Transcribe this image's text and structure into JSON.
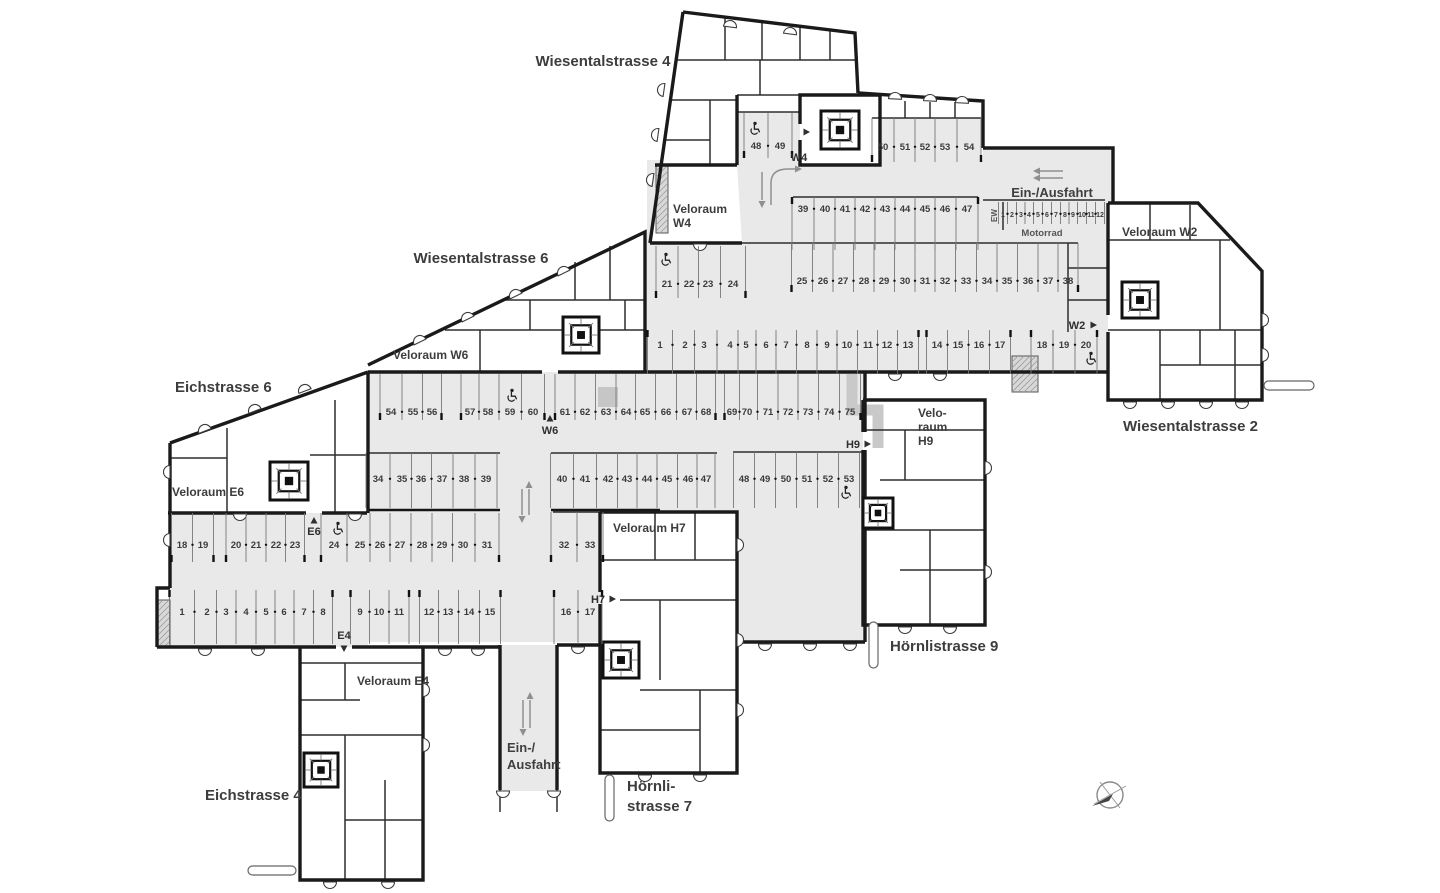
{
  "streets": [
    {
      "id": "wiesentalstrasse-4",
      "text": "Wiesentalstrasse 4",
      "x": 603,
      "y": 66,
      "anchor": "middle"
    },
    {
      "id": "wiesentalstrasse-6",
      "text": "Wiesentalstrasse 6",
      "x": 481,
      "y": 263,
      "anchor": "middle"
    },
    {
      "id": "eichstrasse-6",
      "text": "Eichstrasse 6",
      "x": 175,
      "y": 392,
      "anchor": "start"
    },
    {
      "id": "eichstrasse-4",
      "text": "Eichstrasse 4",
      "x": 205,
      "y": 800,
      "anchor": "start"
    },
    {
      "id": "hoernlistrasse-7",
      "lines": [
        "Hörnli-",
        "strasse 7"
      ],
      "x": 627,
      "y": 791,
      "anchor": "start"
    },
    {
      "id": "hoernlistrasse-9",
      "text": "Hörnlistrasse 9",
      "x": 890,
      "y": 651,
      "anchor": "start"
    },
    {
      "id": "wiesentalstrasse-2",
      "text": "Wiesentalstrasse 2",
      "x": 1123,
      "y": 431,
      "anchor": "start"
    }
  ],
  "room_labels": [
    {
      "id": "veloraum-w4",
      "lines": [
        "Veloraum",
        "W4"
      ],
      "x": 673,
      "y": 213
    },
    {
      "id": "veloraum-w6",
      "lines": [
        "Veloraum W6"
      ],
      "x": 393,
      "y": 359
    },
    {
      "id": "veloraum-e6",
      "lines": [
        "Veloraum E6"
      ],
      "x": 172,
      "y": 496
    },
    {
      "id": "veloraum-e4",
      "lines": [
        "Veloraum E4"
      ],
      "x": 357,
      "y": 685
    },
    {
      "id": "veloraum-h7",
      "lines": [
        "Veloraum H7"
      ],
      "x": 613,
      "y": 532
    },
    {
      "id": "veloraum-h9",
      "lines": [
        "Velo-",
        "raum",
        "H9"
      ],
      "x": 918,
      "y": 417
    },
    {
      "id": "veloraum-w2",
      "lines": [
        "Veloraum W2"
      ],
      "x": 1122,
      "y": 236
    }
  ],
  "entrance_markers": [
    {
      "id": "w4",
      "text": "W4",
      "x": 799,
      "y": 161,
      "tri": "right",
      "tx": 806,
      "ty": 132
    },
    {
      "id": "w6",
      "text": "W6",
      "x": 550,
      "y": 434,
      "tri": "up",
      "tx": 550,
      "ty": 419
    },
    {
      "id": "e6",
      "text": "E6",
      "x": 314,
      "y": 535,
      "tri": "up",
      "tx": 314,
      "ty": 521
    },
    {
      "id": "e4",
      "text": "E4",
      "x": 344,
      "y": 639,
      "tri": "down",
      "tx": 344,
      "ty": 648
    },
    {
      "id": "w2",
      "text": "W2",
      "x": 1077,
      "y": 329,
      "tri": "right",
      "tx": 1093,
      "ty": 325
    },
    {
      "id": "h7",
      "text": "H7",
      "x": 598,
      "y": 603,
      "tri": "right",
      "tx": 612,
      "ty": 599
    },
    {
      "id": "h9",
      "text": "H9",
      "x": 853,
      "y": 448,
      "tri": "right",
      "tx": 867,
      "ty": 444
    }
  ],
  "driveway_labels": [
    {
      "id": "ein-ausfahrt-top",
      "lines": [
        "Ein-/Ausfahrt"
      ],
      "x": 1052,
      "y": 197,
      "anchor": "middle"
    },
    {
      "id": "ein-ausfahrt-bottom",
      "lines": [
        "Ein-/",
        "Ausfahrt"
      ],
      "x": 507,
      "y": 752,
      "anchor": "start"
    }
  ],
  "motorrad": {
    "label": "Motorrad",
    "lx": 1042,
    "ly": 236,
    "ew": "EW",
    "ewx": 997,
    "ewy": 222,
    "row": {
      "id": "motorrad-row",
      "y1": 202,
      "y2": 224,
      "ty": 217,
      "fs": 7,
      "tick": "none",
      "spots": [
        {
          "n": "1",
          "x": 1003
        },
        {
          "n": "2",
          "x": 1012
        },
        {
          "n": "3",
          "x": 1021
        },
        {
          "n": "4",
          "x": 1029
        },
        {
          "n": "5",
          "x": 1038
        },
        {
          "n": "6",
          "x": 1047
        },
        {
          "n": "7",
          "x": 1056
        },
        {
          "n": "8",
          "x": 1065
        },
        {
          "n": "9",
          "x": 1073
        },
        {
          "n": "10",
          "x": 1082
        },
        {
          "n": "11",
          "x": 1091
        },
        {
          "n": "12",
          "x": 1100
        }
      ]
    }
  },
  "parking_rows": [
    {
      "id": "w-48-49",
      "y1": 113,
      "y2": 158,
      "ty": 149,
      "tick": "bottom",
      "spots": [
        {
          "n": "48",
          "x": 756
        },
        {
          "n": "49",
          "x": 780
        }
      ]
    },
    {
      "id": "w-50-54",
      "y1": 118,
      "y2": 162,
      "ty": 150,
      "tick": "bottom",
      "spots": [
        {
          "n": "50",
          "x": 883
        },
        {
          "n": "51",
          "x": 905
        },
        {
          "n": "52",
          "x": 925
        },
        {
          "n": "53",
          "x": 945
        },
        {
          "n": "54",
          "x": 969
        }
      ]
    },
    {
      "id": "w-39-47",
      "y1": 197,
      "y2": 250,
      "ty": 212,
      "tick": "top",
      "spots": [
        {
          "n": "39",
          "x": 803
        },
        {
          "n": "40",
          "x": 825
        },
        {
          "n": "41",
          "x": 845
        },
        {
          "n": "42",
          "x": 865
        },
        {
          "n": "43",
          "x": 885
        },
        {
          "n": "44",
          "x": 905
        },
        {
          "n": "45",
          "x": 925
        },
        {
          "n": "46",
          "x": 945
        },
        {
          "n": "47",
          "x": 967
        }
      ]
    },
    {
      "id": "w-21-24",
      "y1": 246,
      "y2": 298,
      "ty": 287,
      "tick": "bottom",
      "spots": [
        {
          "n": "21",
          "x": 667
        },
        {
          "n": "22",
          "x": 689
        },
        {
          "n": "23",
          "x": 708
        },
        {
          "n": "24",
          "x": 733
        }
      ]
    },
    {
      "id": "w-25-38",
      "y1": 243,
      "y2": 292,
      "ty": 284,
      "tick": "bottom",
      "spots": [
        {
          "n": "25",
          "x": 802
        },
        {
          "n": "26",
          "x": 823
        },
        {
          "n": "27",
          "x": 843
        },
        {
          "n": "28",
          "x": 864
        },
        {
          "n": "29",
          "x": 884
        },
        {
          "n": "30",
          "x": 905
        },
        {
          "n": "31",
          "x": 925
        },
        {
          "n": "32",
          "x": 945
        },
        {
          "n": "33",
          "x": 966
        },
        {
          "n": "34",
          "x": 987
        },
        {
          "n": "35",
          "x": 1007
        },
        {
          "n": "36",
          "x": 1028
        },
        {
          "n": "37",
          "x": 1048
        },
        {
          "n": "38",
          "x": 1068
        }
      ]
    },
    {
      "id": "w-1-13",
      "y1": 330,
      "y2": 374,
      "ty": 348,
      "tick": "top",
      "spots": [
        {
          "n": "1",
          "x": 660
        },
        {
          "n": "2",
          "x": 685
        },
        {
          "n": "3",
          "x": 704
        },
        {
          "n": "4",
          "x": 730
        },
        {
          "n": "5",
          "x": 746
        },
        {
          "n": "6",
          "x": 766
        },
        {
          "n": "7",
          "x": 786
        },
        {
          "n": "8",
          "x": 807
        },
        {
          "n": "9",
          "x": 827
        },
        {
          "n": "10",
          "x": 847
        },
        {
          "n": "11",
          "x": 868
        },
        {
          "n": "12",
          "x": 887
        },
        {
          "n": "13",
          "x": 908
        }
      ]
    },
    {
      "id": "w-14-17",
      "y1": 330,
      "y2": 374,
      "ty": 348,
      "tick": "top",
      "spots": [
        {
          "n": "14",
          "x": 937
        },
        {
          "n": "15",
          "x": 958
        },
        {
          "n": "16",
          "x": 979
        },
        {
          "n": "17",
          "x": 1000
        }
      ]
    },
    {
      "id": "w-18-20",
      "y1": 330,
      "y2": 374,
      "ty": 348,
      "tick": "top",
      "spots": [
        {
          "n": "18",
          "x": 1042
        },
        {
          "n": "19",
          "x": 1064
        },
        {
          "n": "20",
          "x": 1086
        }
      ]
    },
    {
      "id": "m-54-56",
      "y1": 374,
      "y2": 420,
      "ty": 415,
      "tick": "bottom",
      "spots": [
        {
          "n": "54",
          "x": 391
        },
        {
          "n": "55",
          "x": 413
        },
        {
          "n": "56",
          "x": 432
        }
      ]
    },
    {
      "id": "m-57-60",
      "y1": 374,
      "y2": 420,
      "ty": 415,
      "tick": "bottom",
      "spots": [
        {
          "n": "57",
          "x": 470
        },
        {
          "n": "58",
          "x": 488
        },
        {
          "n": "59",
          "x": 510
        },
        {
          "n": "60",
          "x": 533
        }
      ]
    },
    {
      "id": "m-61-68",
      "y1": 374,
      "y2": 420,
      "ty": 415,
      "tick": "bottom",
      "spots": [
        {
          "n": "61",
          "x": 565
        },
        {
          "n": "62",
          "x": 585
        },
        {
          "n": "63",
          "x": 606
        },
        {
          "n": "64",
          "x": 626
        },
        {
          "n": "65",
          "x": 645
        },
        {
          "n": "66",
          "x": 666
        },
        {
          "n": "67",
          "x": 687
        },
        {
          "n": "68",
          "x": 706
        }
      ]
    },
    {
      "id": "m-69-75",
      "y1": 374,
      "y2": 420,
      "ty": 415,
      "tick": "bottom",
      "spots": [
        {
          "n": "69",
          "x": 732
        },
        {
          "n": "70",
          "x": 747
        },
        {
          "n": "71",
          "x": 768
        },
        {
          "n": "72",
          "x": 788
        },
        {
          "n": "73",
          "x": 808
        },
        {
          "n": "74",
          "x": 829
        },
        {
          "n": "75",
          "x": 850
        }
      ]
    },
    {
      "id": "m-34-39",
      "y1": 453,
      "y2": 508,
      "ty": 482,
      "tick": "none",
      "spots": [
        {
          "n": "34",
          "x": 378
        },
        {
          "n": "35",
          "x": 402
        },
        {
          "n": "36",
          "x": 421
        },
        {
          "n": "37",
          "x": 442
        },
        {
          "n": "38",
          "x": 464
        },
        {
          "n": "39",
          "x": 486
        }
      ]
    },
    {
      "id": "m-40-47",
      "y1": 453,
      "y2": 508,
      "ty": 482,
      "tick": "none",
      "spots": [
        {
          "n": "40",
          "x": 562
        },
        {
          "n": "41",
          "x": 585
        },
        {
          "n": "42",
          "x": 608
        },
        {
          "n": "43",
          "x": 627
        },
        {
          "n": "44",
          "x": 647
        },
        {
          "n": "45",
          "x": 667
        },
        {
          "n": "46",
          "x": 688
        },
        {
          "n": "47",
          "x": 706
        }
      ]
    },
    {
      "id": "m-48-53",
      "y1": 452,
      "y2": 508,
      "ty": 482,
      "tick": "none",
      "spots": [
        {
          "n": "48",
          "x": 744
        },
        {
          "n": "49",
          "x": 765
        },
        {
          "n": "50",
          "x": 786
        },
        {
          "n": "51",
          "x": 807
        },
        {
          "n": "52",
          "x": 828
        },
        {
          "n": "53",
          "x": 849
        }
      ]
    },
    {
      "id": "m-18-19",
      "y1": 513,
      "y2": 562,
      "ty": 548,
      "tick": "bottom",
      "spots": [
        {
          "n": "18",
          "x": 182
        },
        {
          "n": "19",
          "x": 203
        }
      ]
    },
    {
      "id": "m-20-23",
      "y1": 513,
      "y2": 562,
      "ty": 548,
      "tick": "bottom",
      "spots": [
        {
          "n": "20",
          "x": 236
        },
        {
          "n": "21",
          "x": 256
        },
        {
          "n": "22",
          "x": 276
        },
        {
          "n": "23",
          "x": 295
        }
      ]
    },
    {
      "id": "m-24-31",
      "y1": 513,
      "y2": 562,
      "ty": 548,
      "tick": "bottom",
      "spots": [
        {
          "n": "24",
          "x": 334
        },
        {
          "n": "25",
          "x": 360
        },
        {
          "n": "26",
          "x": 380
        },
        {
          "n": "27",
          "x": 400
        },
        {
          "n": "28",
          "x": 422
        },
        {
          "n": "29",
          "x": 442
        },
        {
          "n": "30",
          "x": 463
        },
        {
          "n": "31",
          "x": 487
        }
      ]
    },
    {
      "id": "m-32-33",
      "y1": 512,
      "y2": 562,
      "ty": 548,
      "tick": "bottom",
      "spots": [
        {
          "n": "32",
          "x": 564
        },
        {
          "n": "33",
          "x": 590
        }
      ]
    },
    {
      "id": "m-1-8",
      "y1": 590,
      "y2": 644,
      "ty": 615,
      "tick": "top",
      "spots": [
        {
          "n": "1",
          "x": 182
        },
        {
          "n": "2",
          "x": 207
        },
        {
          "n": "3",
          "x": 226
        },
        {
          "n": "4",
          "x": 246
        },
        {
          "n": "5",
          "x": 266
        },
        {
          "n": "6",
          "x": 284
        },
        {
          "n": "7",
          "x": 304
        },
        {
          "n": "8",
          "x": 323
        }
      ]
    },
    {
      "id": "m-9-11",
      "y1": 590,
      "y2": 644,
      "ty": 615,
      "tick": "top",
      "spots": [
        {
          "n": "9",
          "x": 360
        },
        {
          "n": "10",
          "x": 379
        },
        {
          "n": "11",
          "x": 399
        }
      ]
    },
    {
      "id": "m-12-15",
      "y1": 590,
      "y2": 644,
      "ty": 615,
      "tick": "top",
      "spots": [
        {
          "n": "12",
          "x": 429
        },
        {
          "n": "13",
          "x": 448
        },
        {
          "n": "14",
          "x": 469
        },
        {
          "n": "15",
          "x": 490
        }
      ]
    },
    {
      "id": "m-16-17",
      "y1": 590,
      "y2": 644,
      "ty": 615,
      "tick": "top",
      "spots": [
        {
          "n": "16",
          "x": 566
        },
        {
          "n": "17",
          "x": 590
        }
      ]
    }
  ],
  "wheelchairs": [
    {
      "x": 755,
      "y": 128
    },
    {
      "x": 666,
      "y": 259
    },
    {
      "x": 1091,
      "y": 358
    },
    {
      "x": 512,
      "y": 395
    },
    {
      "x": 846,
      "y": 492
    },
    {
      "x": 338,
      "y": 528
    }
  ]
}
